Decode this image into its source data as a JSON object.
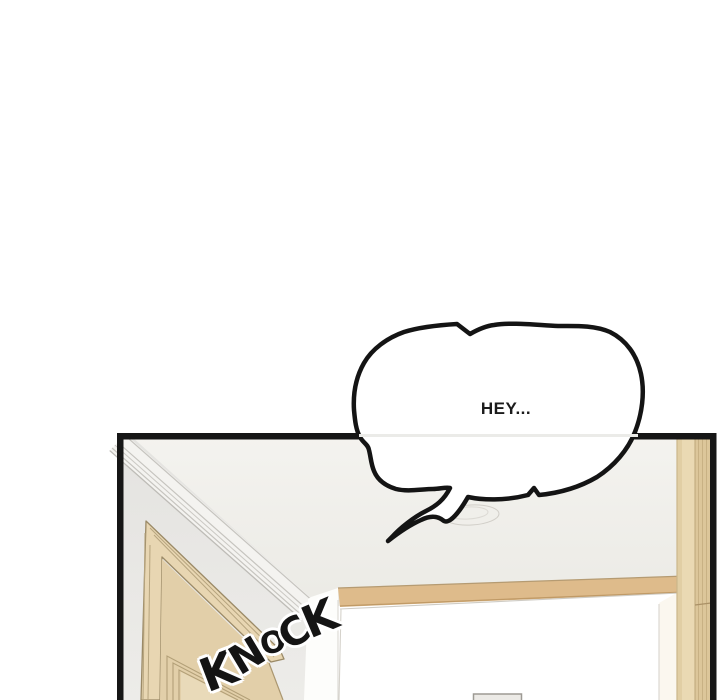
{
  "page": {
    "background_color": "#ffffff",
    "width": 720,
    "height": 700
  },
  "panel": {
    "border_color": "#161616",
    "scene_description": "hallway ceiling corner with wooden door on left and bright open doorway on right",
    "colors": {
      "ceiling": "#f0efeb",
      "wall": "#e6e5e2",
      "molding_line": "#c6c4bf",
      "door_casing_wood": "#e8d6b2",
      "door_slab_wood": "#e2cfa9",
      "door_edge_line": "#9b8a67",
      "doorway_light": "#ffffff",
      "doorway_header_wood": "#debb8b",
      "right_frame_wood_light": "#ead9b3",
      "right_frame_wood_dark": "#dcc69a",
      "switch_plate": "#eceae6"
    }
  },
  "speech_bubble": {
    "text": "HEY...",
    "fill_color": "#ffffff",
    "outline_color": "#141414",
    "text_color": "#1b1b1b"
  },
  "sfx": {
    "text": "KNOCK",
    "color": "#141414",
    "halo_color": "#ffffff"
  }
}
